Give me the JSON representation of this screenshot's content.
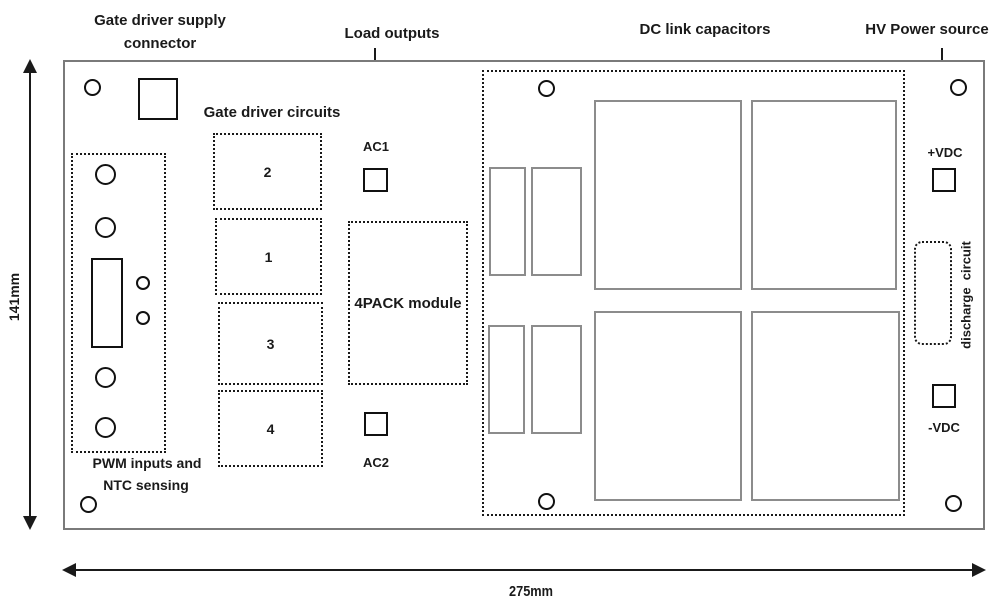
{
  "annotations": {
    "gate_driver_supply": {
      "line1": "Gate driver supply",
      "line2": "connector"
    },
    "load_outputs": "Load outputs",
    "dc_link_capacitors": "DC link capacitors",
    "hv_power_source": "HV Power source"
  },
  "board": {
    "gate_driver_circuits": {
      "title": "Gate driver circuits",
      "boxes": [
        "2",
        "1",
        "3",
        "4"
      ]
    },
    "pwm": {
      "line1": "PWM inputs and",
      "line2": "NTC sensing"
    },
    "module": "4PACK module",
    "load_terminals": {
      "ac1": "AC1",
      "ac2": "AC2"
    },
    "power_terminals": {
      "positive": "+VDC",
      "negative": "-VDC"
    },
    "discharge": "discharge  circuit"
  },
  "dimensions": {
    "height": "141mm",
    "width": "275mm"
  },
  "colors": {
    "line": "#1a1a1a",
    "board_outline": "#7a7a7a",
    "capacitor_outline": "#8c8c8c"
  }
}
